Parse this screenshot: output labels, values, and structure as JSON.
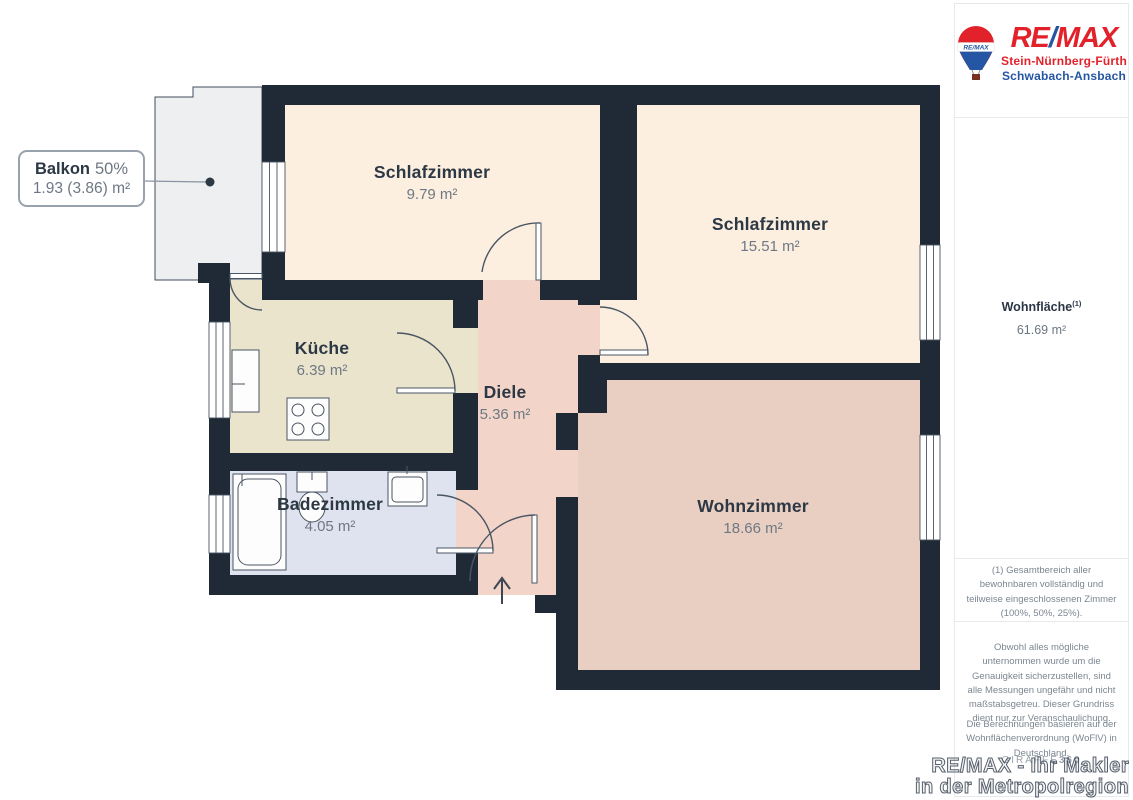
{
  "floorplan": {
    "rooms": [
      {
        "name": "Schlafzimmer",
        "area": "9.79 m²"
      },
      {
        "name": "Schlafzimmer",
        "area": "15.51 m²"
      },
      {
        "name": "Küche",
        "area": "6.39 m²"
      },
      {
        "name": "Diele",
        "area": "5.36 m²"
      },
      {
        "name": "Badezimmer",
        "area": "4.05 m²"
      },
      {
        "name": "Wohnzimmer",
        "area": "18.66 m²"
      }
    ],
    "balcony_callout": {
      "name": "Balkon",
      "share": "50%",
      "area": "1.93 (3.86) m²"
    }
  },
  "sidebar": {
    "logo": {
      "brand_re": "RE",
      "brand_slash": "/",
      "brand_max": "MAX",
      "balloon_text": "RE/MAX",
      "line1": "Stein-Nürnberg-Fürth",
      "line2": "Schwabach-Ansbach"
    },
    "total": {
      "label": "Wohnfläche",
      "footnote_ref": "(1)",
      "value": "61.69 m²"
    },
    "footnote": "(1) Gesamtbereich aller bewohnbaren vollständig und teilweise eingeschlossenen Zimmer (100%, 50%, 25%).",
    "disclaimer1": "Obwohl alles mögliche unternommen wurde um die Genauigkeit sicherzustellen, sind alle Messungen ungefähr und nicht maßstabsgetreu. Dieser Grundriss dient nur zur Veranschaulichung.",
    "disclaimer2": "Die Berechnungen basieren auf der Wohnflächenverordnung (WoFlV) in Deutschland.",
    "brand_mark": {
      "giraffe": "GIRAFFE",
      "threesixty": "360"
    }
  },
  "watermark": {
    "line1": "RE/MAX - Ihr Makler",
    "line2": "in der Metropolregion"
  },
  "colors": {
    "wall": "#202a37",
    "bedroom_fill": "#fcefe0",
    "kitchen_fill": "#eae4cd",
    "hall_fill": "#f2d5c8",
    "living_fill": "#e9cfc2",
    "bath_fill": "#dfe3f0",
    "balcony_fill": "#edeff1",
    "brand_red": "#e2222a",
    "brand_blue": "#2456a4"
  }
}
